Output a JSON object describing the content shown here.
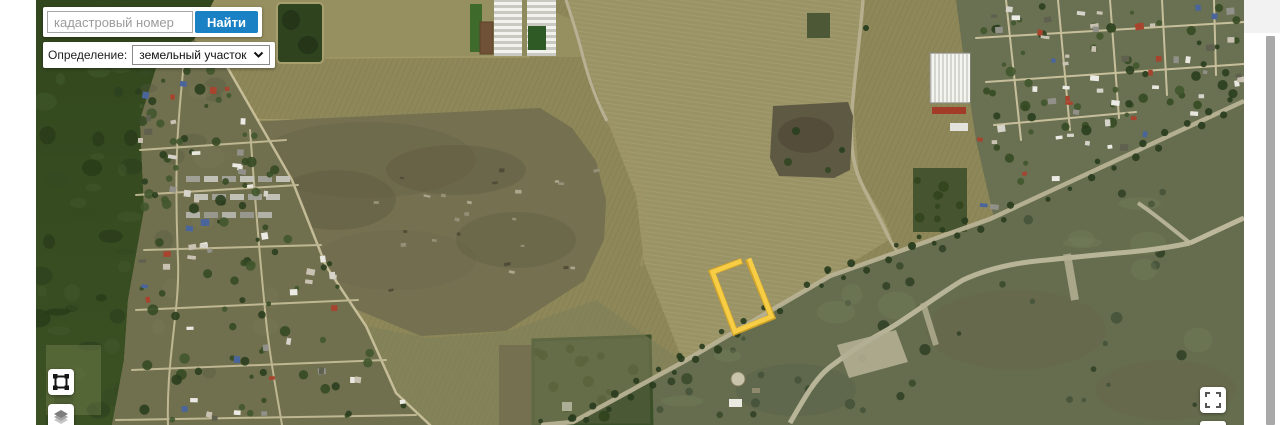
{
  "toolbar": {
    "search_placeholder": "кадастровый номер",
    "search_button_label": "Найти",
    "definition_label": "Определение:",
    "definition_selected": "земельный участок"
  },
  "map": {
    "type": "satellite-imagery",
    "highlighted_parcel": {
      "stroke_color": "#f6cd44",
      "shape": "quadrilateral"
    },
    "controls": {
      "draw_extent_button": "draw-extent",
      "layers_button": "layers",
      "fullscreen_button": "fullscreen"
    }
  },
  "colors": {
    "search_button_bg": "#1a82c4",
    "page_bg": "#ffffff",
    "scrollbar_thumb": "#a9a9a9"
  }
}
